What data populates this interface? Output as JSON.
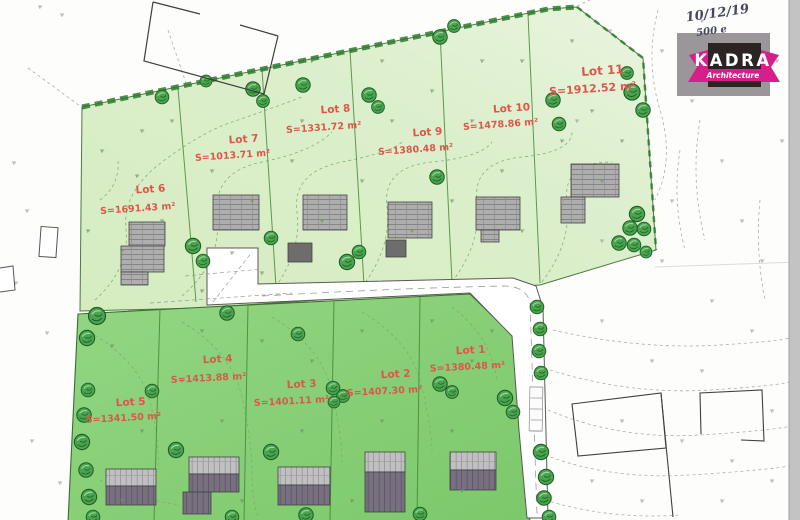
{
  "annotations": {
    "date": "10/12/19",
    "price": "500 e"
  },
  "logo": {
    "brand": "KADRA",
    "subtitle": "Architecture"
  },
  "lots": [
    {
      "id": 1,
      "name": "Lot 1",
      "area": "S=1380.48 m²"
    },
    {
      "id": 2,
      "name": "Lot 2",
      "area": "S=1407.30 m²"
    },
    {
      "id": 3,
      "name": "Lot 3",
      "area": "S=1401.11 m²"
    },
    {
      "id": 4,
      "name": "Lot 4",
      "area": "S=1413.88 m²"
    },
    {
      "id": 5,
      "name": "Lot 5",
      "area": "S=1341.50 m²"
    },
    {
      "id": 6,
      "name": "Lot 6",
      "area": "S=1691.43 m²"
    },
    {
      "id": 7,
      "name": "Lot 7",
      "area": "S=1013.71 m²"
    },
    {
      "id": 8,
      "name": "Lot 8",
      "area": "S=1331.72 m²"
    },
    {
      "id": 9,
      "name": "Lot 9",
      "area": "S=1380.48 m²"
    },
    {
      "id": 10,
      "name": "Lot 10",
      "area": "S=1478.86 m²"
    },
    {
      "id": 11,
      "name": "Lot 11",
      "area": "S=1912.52 m²"
    }
  ],
  "colors": {
    "upper_parcel_green": "#dbeecb",
    "lower_parcel_green": "#8bd079",
    "tree_green": "#4aa34e",
    "hedge_green": "#2c7a2e",
    "lot_label_red": "#dc574b",
    "road_white": "#ffffff",
    "building_gray": "#aeaeae",
    "building_dark_gray": "#6d6d6d",
    "building_purple_gray": "#78707f",
    "logo_magenta": "#d61f8b",
    "logo_dark": "#2b2422",
    "logo_gray": "#9b969a"
  }
}
